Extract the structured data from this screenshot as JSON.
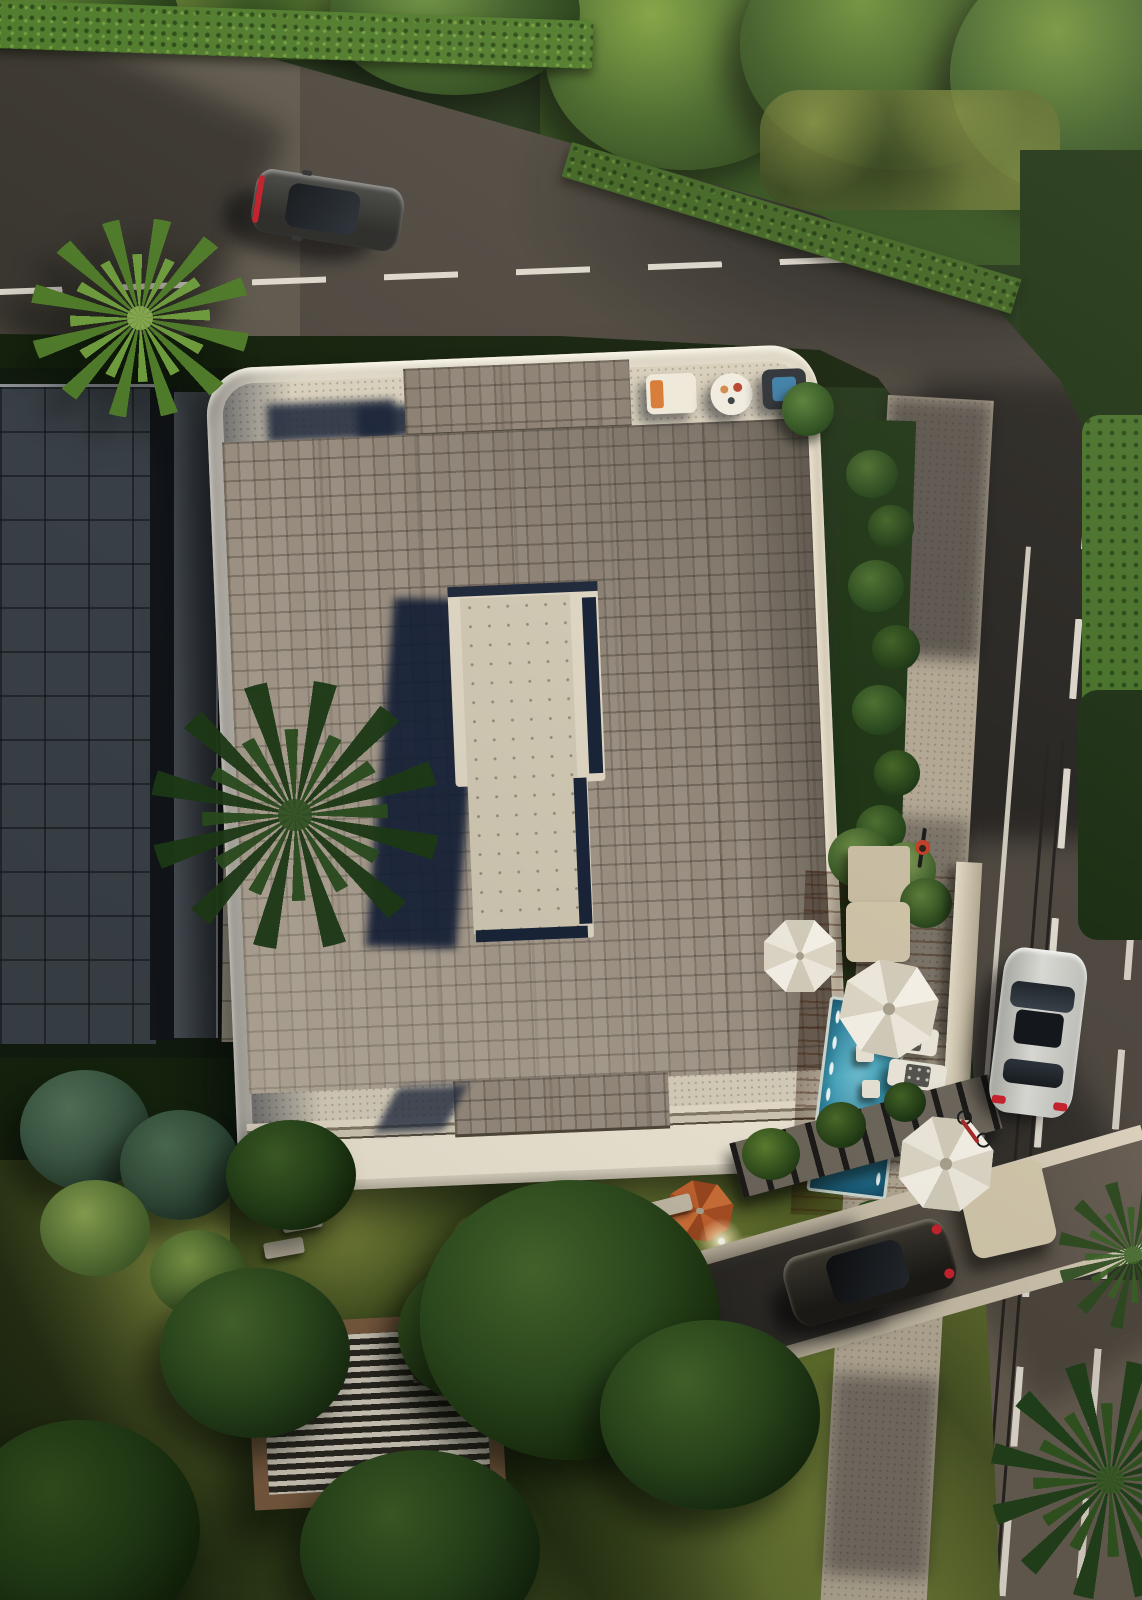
{
  "scene": {
    "title": "Aerial top-down 3D architectural render of a modern tiled-roof villa with pool terrace, roads and gardens",
    "sun_direction": "upper-right, long shadows cast toward lower-left",
    "canvas": {
      "width": 1142,
      "height": 1600
    }
  },
  "palette": {
    "asphalt": "#4f4941",
    "asphalt_shadow": "#2c2824",
    "asphalt_sunlit": "#6b6156",
    "road_marking_white": "#e9e3d8",
    "grass_sun": "#8e9a44",
    "grass_mid": "#5a682c",
    "foliage_dark": "#1c2e13",
    "foliage_sun": "#557a2e",
    "hedge_green": "#4e7a2b",
    "roof_tile": "#978b7d",
    "roof_tile_light": "#b5a995",
    "concrete_walkway": "#d8cfbc",
    "frame_cream": "#ece4d1",
    "shadow_navy": "#1b2539",
    "pool_water": "#2f86a3",
    "pool_water_light": "#49b0c6",
    "deck_wood": "#a5602d",
    "umbrella_white": "#f4f0e6",
    "parasol_orange": "#c26434",
    "car_dark_gray": "#353432",
    "car_white": "#d3d2cd",
    "car_black": "#221f1b",
    "neighbor_roof": "#4d555d",
    "paver_light": "#cabfa9",
    "sidewalk": "#b2a793",
    "pergola_wood": "#7c5d41",
    "pergola_slat_dark": "#2c2822",
    "pergola_slat_light": "#d6cfc0"
  },
  "objects": {
    "villa": {
      "label": "main villa rooftop with cream rounded parapet frame",
      "roof": "grey shingle-tiled roof, brighter toward lower left",
      "skylight": "raised central rooftop monitor with dotted concrete top casting a long navy shadow to the left",
      "raised_block": "raised roof step at top edge",
      "terrace": "rooftop terrace with sofa, round table, chair and potted plant"
    },
    "neighbor_building": {
      "label": "neighboring flat-roofed building with blue-grey tile grid, in shadow"
    },
    "roads": {
      "top_road": "asphalt road running left-right with white dashed center line",
      "right_road": "asphalt road curving down the right side with dashed and solid markings",
      "sidewalk": "speckled concrete sidewalk along the right road",
      "driveway": "private driveway with concrete curbs at lower right",
      "entry_slab": "concrete gate slab at driveway entrance"
    },
    "pool_area": {
      "pool": "turquoise lap pool with white edge lights",
      "deck": "orange hardwood pool deck",
      "umbrellas_white": 3,
      "parasol_orange": 1,
      "sun_loungers": 3,
      "side_tables": 2,
      "cabana": "beige pool cabana",
      "planter": "rooftop planter with shrubs"
    },
    "vehicles": {
      "car_top_road": "dark grey coupe driving on the top road",
      "car_right_road": "white sedan driving on the right road",
      "car_driveway": "black car parked on the driveway",
      "bicycles": 2,
      "cyclist": "cyclist with red top on the sidewalk"
    },
    "landscape": {
      "palm_trees": 4,
      "hedges": "trimmed hedges along the roads",
      "trees": "dense garden trees and conifers",
      "lawn": "sunlit mottled lawn with long tree shadows",
      "path_lights": 5,
      "stepping_stones": "stone garden paths",
      "pergola": "slatted wooden pergola at lower left",
      "slat_fence": "dark slatted fence along garden walkway"
    }
  }
}
